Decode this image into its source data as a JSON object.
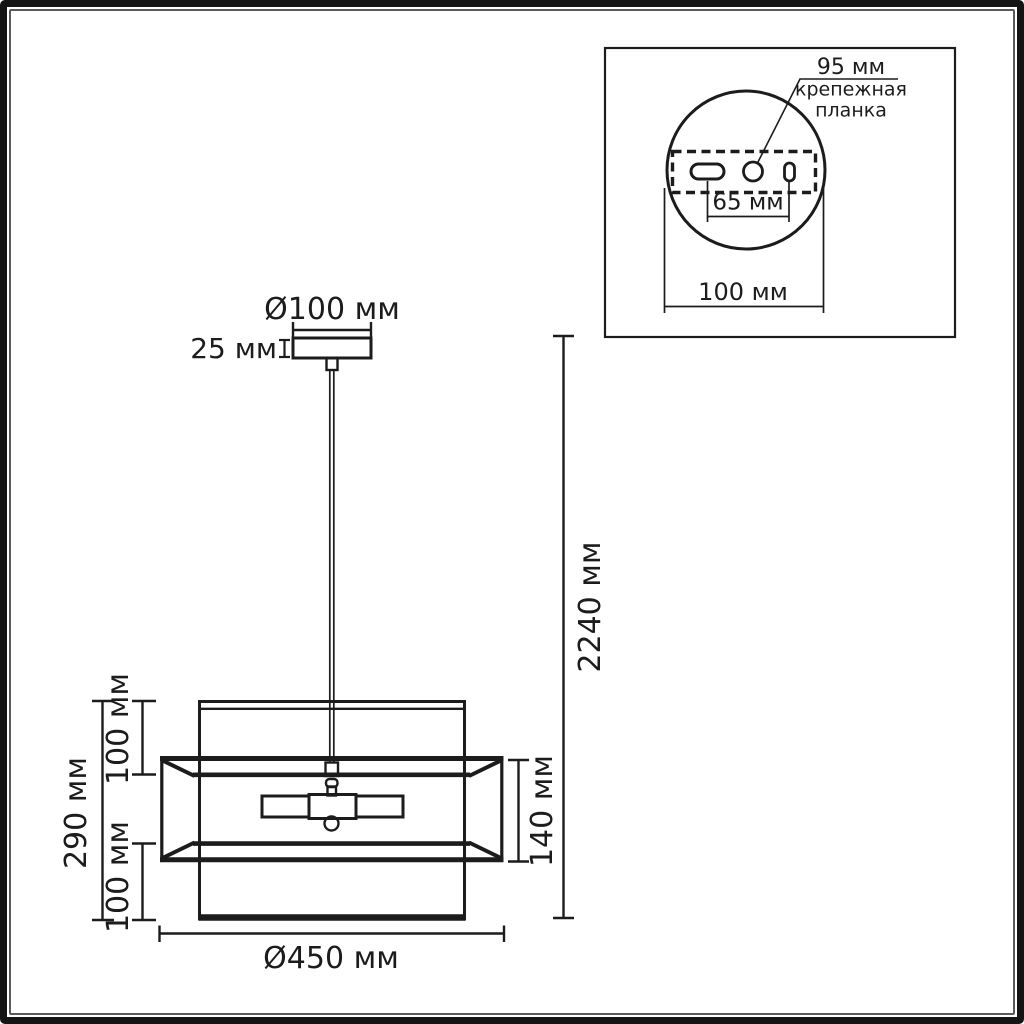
{
  "colors": {
    "ink": "#1c1c1c",
    "leader_gray": "#8f8f8f",
    "background": "#ffffff"
  },
  "front_view": {
    "canopy_diameter_label": "Ø100 мм",
    "canopy_height_label": "25 мм",
    "overall_height_label": "2240 мм",
    "band_height_label": "140 мм",
    "shade_height_label": "290 мм",
    "upper_section_label": "100 мм",
    "lower_section_label": "100 мм",
    "shade_diameter_label": "Ø450 мм"
  },
  "top_view_inset": {
    "plate_length_label": "95 мм",
    "plate_name_label": "крепежная\nпланка",
    "hole_spacing_label": "65 мм",
    "base_diameter_label": "100 мм"
  }
}
